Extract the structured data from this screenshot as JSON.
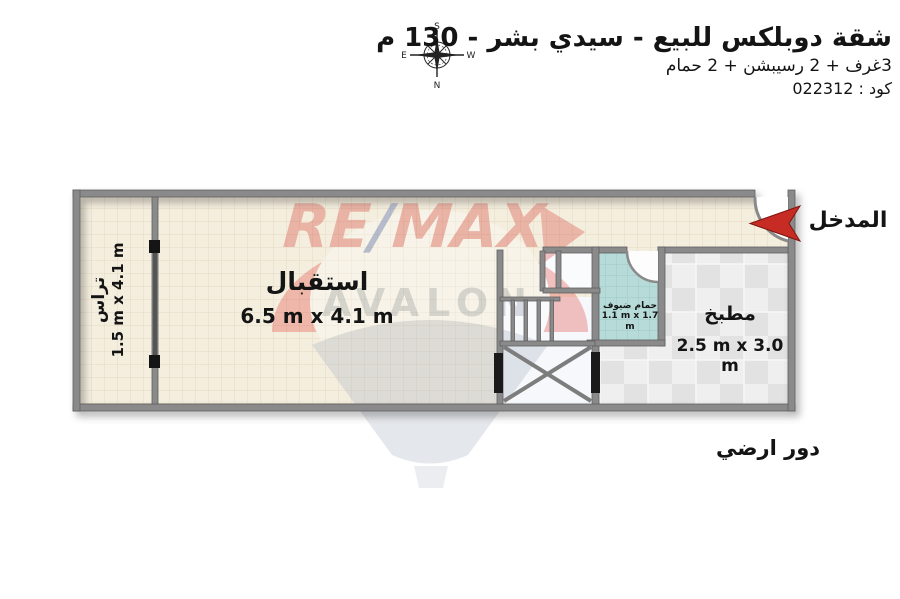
{
  "header": {
    "title": "شقة دوبلكس للبيع - سيدي بشر - 130 م",
    "subtitle": "3غرف + 2 رسيبشن + 2 حمام",
    "code": "كود : 022312",
    "compass": {
      "top": "S",
      "bottom": "N",
      "left": "E",
      "right": "W"
    }
  },
  "plan": {
    "entrance_label": "المدخل",
    "floor_label": "دور ارضي",
    "rooms": [
      {
        "name": "تراس",
        "dims": "1.5 m x 4.1 m"
      },
      {
        "name": "استقبال",
        "dims": "6.5 m x 4.1 m"
      },
      {
        "name": "حمام ضيوف",
        "dims": "1.1 m x 1.7 m"
      },
      {
        "name": "مطبخ",
        "dims": "2.5 m x 3.0 m"
      }
    ]
  },
  "watermark": {
    "brand_re": "RE",
    "brand_slash": "/",
    "brand_max": "MAX",
    "name": "AVALON"
  },
  "colors": {
    "wall_gray": "#8a8a8a",
    "floor_beige": "#f4eede",
    "bath_teal": "#b6dbd8",
    "kitchen_tile": "#e9e9e9",
    "arrow_red": "#c62c24",
    "watermark_red": "#e13a33",
    "watermark_blue": "#2a4ba0",
    "watermark_gray": "#a7b2c2"
  }
}
